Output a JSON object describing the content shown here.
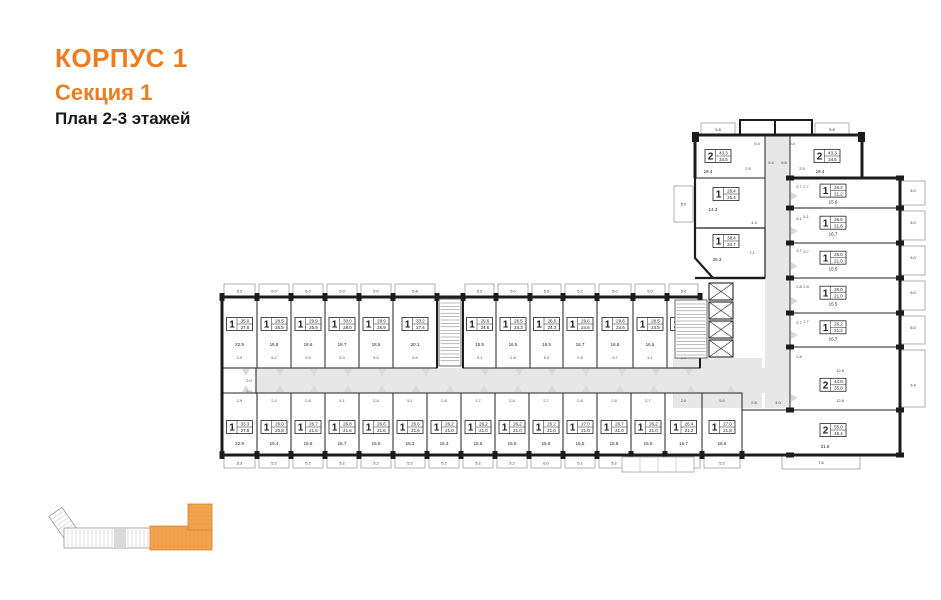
{
  "header": {
    "building": "КОРПУС 1",
    "section": "Секция 1",
    "plan_label": "План 2-3 этажей"
  },
  "colors": {
    "accent": "#ed7d1f",
    "wall": "#1c1c1c",
    "corridor": "#e7e7e7",
    "balcony_line": "#929292",
    "minimap_orange": "#f3a24f",
    "minimap_orange_stroke": "#d8862e"
  },
  "plan": {
    "top_row": [
      {
        "r": "1",
        "t": "35.0",
        "l": "27.8",
        "a": "22.9",
        "b": "5.2",
        "s": "2.9",
        "x": 222,
        "w": 35
      },
      {
        "r": "1",
        "t": "28.5",
        "l": "25.5",
        "a": "16.8",
        "b": "6.0",
        "s": "5.2",
        "x": 257,
        "w": 34
      },
      {
        "r": "1",
        "t": "29.9",
        "l": "26.9",
        "a": "18.6",
        "b": "6.0",
        "s": "3.5",
        "x": 291,
        "w": 34
      },
      {
        "r": "1",
        "t": "30.0",
        "l": "28.0",
        "a": "18.7",
        "b": "5.0",
        "s": "5.3",
        "x": 325,
        "w": 34
      },
      {
        "r": "1",
        "t": "28.9",
        "l": "26.9",
        "a": "18.5",
        "b": "5.0",
        "s": "5.0",
        "x": 359,
        "w": 34
      },
      {
        "r": "1",
        "t": "33.2",
        "l": "27.4",
        "a": "20.1",
        "b": "5.8",
        "s": "5.6",
        "x": 393,
        "w": 44
      },
      {
        "r": "1",
        "t": "29.6",
        "l": "24.6",
        "a": "16.5",
        "b": "5.2",
        "s": "3.1",
        "x": 463,
        "w": 33
      },
      {
        "r": "1",
        "t": "26.5",
        "l": "24.3",
        "a": "16.5",
        "b": "5.0",
        "s": "2.8",
        "x": 496,
        "w": 34
      },
      {
        "r": "1",
        "t": "26.5",
        "l": "24.3",
        "a": "18.5",
        "b": "5.0",
        "s": "5.0",
        "x": 530,
        "w": 33
      },
      {
        "r": "1",
        "t": "29.6",
        "l": "24.6",
        "a": "16.7",
        "b": "5.2",
        "s": "2.8",
        "x": 563,
        "w": 34
      },
      {
        "r": "1",
        "t": "29.6",
        "l": "24.6",
        "a": "16.5",
        "b": "5.0",
        "s": "3.7",
        "x": 597,
        "w": 36
      },
      {
        "r": "1",
        "t": "28.5",
        "l": "24.5",
        "a": "16.5",
        "b": "5.0",
        "s": "3.1",
        "x": 633,
        "w": 34
      },
      {
        "r": "1",
        "t": "28.8",
        "l": "24.4",
        "a": "18.5",
        "b": "5.0",
        "s": "2.8",
        "x": 667,
        "w": 33
      }
    ],
    "bottom_row": [
      {
        "r": "1",
        "t": "33.3",
        "l": "27.8",
        "a": "22.9",
        "b": "5.3",
        "s": "2.9",
        "x": 222,
        "w": 35
      },
      {
        "r": "1",
        "t": "26.0",
        "l": "20.8",
        "a": "15.4",
        "b": "5.2",
        "s": "2.4",
        "x": 257,
        "w": 34
      },
      {
        "r": "1",
        "t": "26.7",
        "l": "21.6",
        "a": "15.6",
        "b": "5.2",
        "s": "2.8",
        "x": 291,
        "w": 34
      },
      {
        "r": "1",
        "t": "26.8",
        "l": "21.6",
        "a": "16.7",
        "b": "5.2",
        "s": "5.1",
        "x": 325,
        "w": 34
      },
      {
        "r": "1",
        "t": "26.6",
        "l": "21.6",
        "a": "15.5",
        "b": "5.2",
        "s": "2.8",
        "x": 359,
        "w": 34
      },
      {
        "r": "1",
        "t": "26.6",
        "l": "21.6",
        "a": "15.3",
        "b": "5.2",
        "s": "5.1",
        "x": 393,
        "w": 34
      },
      {
        "r": "1",
        "t": "26.2",
        "l": "21.0",
        "a": "15.3",
        "b": "5.2",
        "s": "2.8",
        "x": 427,
        "w": 34
      },
      {
        "r": "1",
        "t": "26.2",
        "l": "21.0",
        "a": "15.5",
        "b": "5.2",
        "s": "2.7",
        "x": 461,
        "w": 34
      },
      {
        "r": "1",
        "t": "26.2",
        "l": "21.0",
        "a": "15.5",
        "b": "5.2",
        "s": "2.8",
        "x": 495,
        "w": 34
      },
      {
        "r": "1",
        "t": "26.2",
        "l": "21.0",
        "a": "15.5",
        "b": "6.0",
        "s": "2.7",
        "x": 529,
        "w": 34
      },
      {
        "r": "1",
        "t": "27.0",
        "l": "21.0",
        "a": "15.5",
        "b": "5.1",
        "s": "2.8",
        "x": 563,
        "w": 34
      },
      {
        "r": "1",
        "t": "26.7",
        "l": "21.0",
        "a": "15.8",
        "b": "5.2",
        "s": "2.8",
        "x": 597,
        "w": 34
      },
      {
        "r": "1",
        "t": "26.2",
        "l": "21.0",
        "a": "15.5",
        "b": "5.2",
        "s": "2.7",
        "x": 631,
        "w": 34
      },
      {
        "r": "1",
        "t": "26.4",
        "l": "21.2",
        "a": "16.7",
        "b": "5.2",
        "s": "2.8",
        "x": 665,
        "w": 37
      },
      {
        "r": "1",
        "t": "27.0",
        "l": "21.8",
        "a": "15.6",
        "b": "5.2",
        "s": "5.6",
        "x": 702,
        "w": 40
      }
    ],
    "right_col": [
      {
        "r": "1",
        "t": "26.2",
        "l": "21.2",
        "a": "15.6",
        "b": "5.0",
        "s": "2.7",
        "y": 178,
        "h": 30
      },
      {
        "r": "1",
        "t": "26.6",
        "l": "21.6",
        "a": "16.7",
        "b": "5.0",
        "s": "5.1",
        "y": 208,
        "h": 35
      },
      {
        "r": "1",
        "t": "26.0",
        "l": "21.0",
        "a": "15.5",
        "b": "5.0",
        "s": "3.7",
        "y": 243,
        "h": 35
      },
      {
        "r": "1",
        "t": "26.0",
        "l": "21.0",
        "a": "15.5",
        "b": "5.0",
        "s": "2.8",
        "y": 278,
        "h": 35
      },
      {
        "r": "1",
        "t": "26.2",
        "l": "21.2",
        "a": "16.7",
        "b": "5.0",
        "s": "2.7",
        "y": 313,
        "h": 34
      },
      {
        "r": "2",
        "t": "44.8",
        "l": "35.8",
        "a": "",
        "b": "9.4",
        "s": "",
        "y": 347,
        "h": 63,
        "lc": 0.6
      }
    ],
    "specials": [
      {
        "name": "flat-2-top-left",
        "r": "2",
        "t": "43.3",
        "l": "34.5",
        "cx": 718,
        "cy": 156,
        "area": {
          "t": "18.4",
          "x": 708,
          "y": 173
        },
        "balc": {
          "t": "5.8",
          "x": 701,
          "y": 123,
          "w": 34,
          "h": 13
        }
      },
      {
        "name": "flat-2-top-right",
        "r": "2",
        "t": "43.3",
        "l": "34.5",
        "cx": 827,
        "cy": 156,
        "area": {
          "t": "18.4",
          "x": 820,
          "y": 173
        },
        "balc": {
          "t": "5.8",
          "x": 815,
          "y": 123,
          "w": 34,
          "h": 13
        }
      },
      {
        "name": "flat-1-28",
        "r": "1",
        "t": "28.4",
        "l": "25.4",
        "cx": 726,
        "cy": 194,
        "area": {
          "t": "14.3",
          "x": 713,
          "y": 211
        },
        "balc": {
          "t": "5.0",
          "x": 674,
          "y": 186,
          "w": 19,
          "h": 36
        }
      },
      {
        "name": "flat-1-38",
        "r": "1",
        "t": "38.4",
        "l": "34.7",
        "cx": 726,
        "cy": 241,
        "area": {
          "t": "25.3",
          "x": 717,
          "y": 261
        }
      },
      {
        "name": "flat-2-corner",
        "r": "2",
        "t": "55.0",
        "l": "45.4",
        "cx": 833,
        "cy": 430,
        "area": {
          "t": "21.6",
          "x": 825,
          "y": 448
        },
        "balc": {
          "t": "7.6",
          "x": 782,
          "y": 456,
          "w": 78,
          "h": 13
        }
      }
    ],
    "misc_labels": [
      {
        "t": "9.4",
        "x": 757,
        "y": 145
      },
      {
        "t": "9.4",
        "x": 792,
        "y": 145
      },
      {
        "t": "5.4",
        "x": 771,
        "y": 164
      },
      {
        "t": "5.6",
        "x": 784,
        "y": 164
      },
      {
        "t": "2.9",
        "x": 748,
        "y": 170
      },
      {
        "t": "2.9",
        "x": 802,
        "y": 170
      },
      {
        "t": "2.7",
        "x": 799,
        "y": 188
      },
      {
        "t": "5.1",
        "x": 799,
        "y": 220
      },
      {
        "t": "3.7",
        "x": 799,
        "y": 252
      },
      {
        "t": "2.8",
        "x": 799,
        "y": 288
      },
      {
        "t": "2.7",
        "x": 799,
        "y": 324
      },
      {
        "t": "2.8",
        "x": 799,
        "y": 358
      },
      {
        "t": "4.3",
        "x": 754,
        "y": 224
      },
      {
        "t": "7.1",
        "x": 752,
        "y": 254
      },
      {
        "t": "12.8",
        "x": 840,
        "y": 372
      },
      {
        "t": "12.8",
        "x": 840,
        "y": 402
      },
      {
        "t": "2.8",
        "x": 754,
        "y": 404
      },
      {
        "t": "4.0",
        "x": 778,
        "y": 404
      },
      {
        "t": "2.0",
        "x": 249,
        "y": 382
      },
      {
        "t": "2.0",
        "x": 249,
        "y": 393
      }
    ]
  },
  "minimap": {
    "section_highlighted": "Секция 1"
  }
}
